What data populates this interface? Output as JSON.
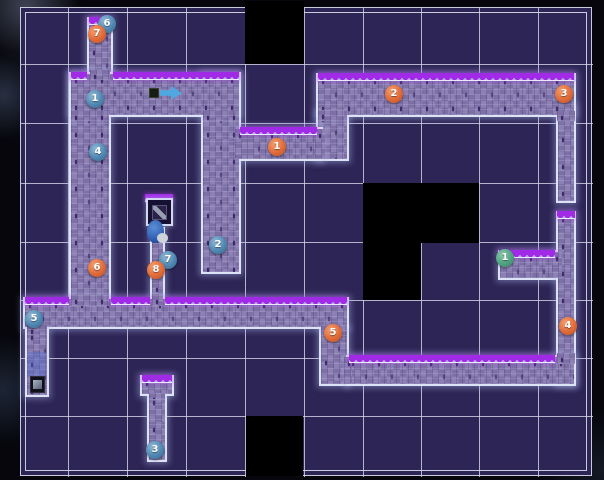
{
  "title": "dungeon-level-map",
  "map": {
    "width": 604,
    "height": 480,
    "colors": {
      "outside": "#06060c",
      "cell": "#2d2555",
      "black_cell": "#000000",
      "grid_line": "rgba(214,217,234,0.8)",
      "frame_line": "#c7cbdc",
      "path_fill": "#8679b0",
      "path_border": "#dde3f7",
      "fringe_teeth": "#a12ae6",
      "marker_orange": "#e06a38",
      "marker_blue": "#4e87b2",
      "marker_green": "#4ea181",
      "arrow_blue": "#4fa8e0"
    },
    "frame": {
      "x": 20,
      "y": 7,
      "w": 572,
      "h": 469,
      "inner_inset": 4
    },
    "grid": {
      "v_lines": [
        67,
        126,
        185,
        244,
        303,
        362,
        420,
        478,
        537
      ],
      "h_lines": [
        63,
        122,
        182,
        241,
        299,
        357,
        415
      ]
    },
    "black_cells": [
      {
        "x": 244,
        "y": 0,
        "w": 59,
        "h": 63
      },
      {
        "x": 362,
        "y": 182,
        "w": 116,
        "h": 60
      },
      {
        "x": 362,
        "y": 242,
        "w": 58,
        "h": 57
      },
      {
        "x": 245,
        "y": 415,
        "w": 57,
        "h": 60
      }
    ],
    "corridors": [
      {
        "name": "left-vertical",
        "x": 68,
        "y": 71,
        "w": 42,
        "h": 229
      },
      {
        "name": "mid-vertical",
        "x": 200,
        "y": 71,
        "w": 40,
        "h": 202
      },
      {
        "name": "stub-top",
        "x": 86,
        "y": 16,
        "w": 26,
        "h": 58
      },
      {
        "name": "upper-left-horizontal",
        "x": 68,
        "y": 71,
        "w": 172,
        "h": 45
      },
      {
        "name": "connector-up",
        "x": 315,
        "y": 110,
        "w": 33,
        "h": 50
      },
      {
        "name": "right-vertical-upper",
        "x": 555,
        "y": 103,
        "w": 20,
        "h": 99
      },
      {
        "name": "waypoint1-horizontal",
        "x": 238,
        "y": 126,
        "w": 84,
        "h": 34
      },
      {
        "name": "top-long",
        "x": 315,
        "y": 72,
        "w": 260,
        "h": 44
      },
      {
        "name": "green-stub",
        "x": 497,
        "y": 249,
        "w": 60,
        "h": 30
      },
      {
        "name": "right-vertical-lower",
        "x": 555,
        "y": 210,
        "w": 20,
        "h": 175
      },
      {
        "name": "sign-corridor",
        "x": 149,
        "y": 226,
        "w": 15,
        "h": 74
      },
      {
        "name": "step-connector",
        "x": 318,
        "y": 326,
        "w": 30,
        "h": 59
      },
      {
        "name": "bottom-left-long",
        "x": 22,
        "y": 296,
        "w": 326,
        "h": 32
      },
      {
        "name": "bottom-left-stub",
        "x": 24,
        "y": 328,
        "w": 24,
        "h": 68
      },
      {
        "name": "bottom-long",
        "x": 345,
        "y": 354,
        "w": 230,
        "h": 31
      },
      {
        "name": "island-stem",
        "x": 146,
        "y": 393,
        "w": 20,
        "h": 68
      },
      {
        "name": "island-top",
        "x": 139,
        "y": 374,
        "w": 34,
        "h": 21
      }
    ],
    "patches": [
      {
        "x": 89,
        "y": 69,
        "w": 20,
        "h": 10
      },
      {
        "x": 70,
        "y": 110,
        "w": 38,
        "h": 10
      },
      {
        "x": 202,
        "y": 110,
        "w": 36,
        "h": 10
      },
      {
        "x": 234,
        "y": 128,
        "w": 12,
        "h": 30
      },
      {
        "x": 317,
        "y": 109,
        "w": 29,
        "h": 11
      },
      {
        "x": 314,
        "y": 128,
        "w": 10,
        "h": 30
      },
      {
        "x": 556,
        "y": 110,
        "w": 18,
        "h": 10
      },
      {
        "x": 556,
        "y": 352,
        "w": 18,
        "h": 11
      },
      {
        "x": 551,
        "y": 251,
        "w": 10,
        "h": 26
      },
      {
        "x": 70,
        "y": 294,
        "w": 38,
        "h": 11
      },
      {
        "x": 151,
        "y": 294,
        "w": 11,
        "h": 11
      },
      {
        "x": 320,
        "y": 324,
        "w": 26,
        "h": 11
      },
      {
        "x": 343,
        "y": 356,
        "w": 8,
        "h": 27
      },
      {
        "x": 26,
        "y": 324,
        "w": 20,
        "h": 10
      },
      {
        "x": 148,
        "y": 392,
        "w": 16,
        "h": 6
      }
    ],
    "fringes": [
      {
        "x": 88,
        "y": 16,
        "w": 22
      },
      {
        "x": 70,
        "y": 71,
        "w": 16
      },
      {
        "x": 112,
        "y": 71,
        "w": 126
      },
      {
        "x": 239,
        "y": 126,
        "w": 77
      },
      {
        "x": 317,
        "y": 72,
        "w": 256
      },
      {
        "x": 556,
        "y": 210,
        "w": 18
      },
      {
        "x": 498,
        "y": 249,
        "w": 56
      },
      {
        "x": 24,
        "y": 296,
        "w": 44
      },
      {
        "x": 110,
        "y": 296,
        "w": 39
      },
      {
        "x": 164,
        "y": 296,
        "w": 182
      },
      {
        "x": 348,
        "y": 354,
        "w": 206
      },
      {
        "x": 141,
        "y": 374,
        "w": 30
      },
      {
        "x": 144,
        "y": 193,
        "w": 28
      }
    ],
    "sprites": [
      {
        "name": "item-box-icon",
        "cls": "item-box",
        "x": 148,
        "y": 87,
        "w": 10,
        "h": 10
      },
      {
        "name": "arrow-right-icon",
        "cls": "arrow-right",
        "x": 159,
        "y": 84,
        "w": 22,
        "h": 16
      },
      {
        "name": "sign-icon",
        "cls": "sign-frame",
        "x": 145,
        "y": 197,
        "w": 27,
        "h": 28
      },
      {
        "name": "player-sprite",
        "cls": "player",
        "x": 146,
        "y": 219,
        "w": 23,
        "h": 28
      },
      {
        "name": "blue-passage-overlay",
        "cls": "blue-passage",
        "x": 27,
        "y": 351,
        "w": 18,
        "h": 24
      },
      {
        "name": "monitor-icon",
        "cls": "monitor",
        "x": 29,
        "y": 375,
        "w": 15,
        "h": 17
      }
    ],
    "markers": [
      {
        "label": "6",
        "type": "blue",
        "x": 106,
        "y": 23
      },
      {
        "label": "7",
        "type": "orange",
        "x": 96,
        "y": 33
      },
      {
        "label": "1",
        "type": "blue",
        "x": 94,
        "y": 98
      },
      {
        "label": "4",
        "type": "blue",
        "x": 97,
        "y": 151
      },
      {
        "label": "2",
        "type": "blue",
        "x": 217,
        "y": 244
      },
      {
        "label": "6",
        "type": "orange",
        "x": 96,
        "y": 267
      },
      {
        "label": "7",
        "type": "blue",
        "x": 167,
        "y": 259
      },
      {
        "label": "8",
        "type": "orange",
        "x": 155,
        "y": 269
      },
      {
        "label": "1",
        "type": "orange",
        "x": 276,
        "y": 146
      },
      {
        "label": "2",
        "type": "orange",
        "x": 393,
        "y": 93
      },
      {
        "label": "3",
        "type": "orange",
        "x": 563,
        "y": 93
      },
      {
        "label": "1",
        "type": "green",
        "x": 504,
        "y": 257
      },
      {
        "label": "4",
        "type": "orange",
        "x": 567,
        "y": 325
      },
      {
        "label": "5",
        "type": "blue",
        "x": 33,
        "y": 318
      },
      {
        "label": "5",
        "type": "orange",
        "x": 332,
        "y": 332
      },
      {
        "label": "3",
        "type": "blue",
        "x": 154,
        "y": 449
      }
    ]
  }
}
